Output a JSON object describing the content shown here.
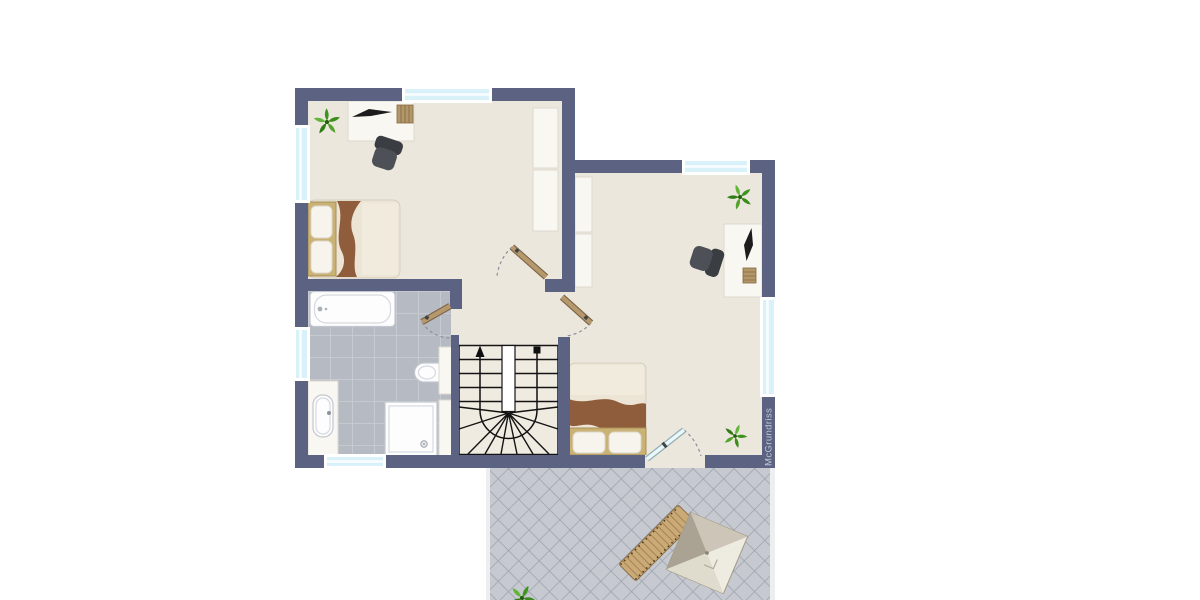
{
  "watermark": "McGrundriss",
  "colors": {
    "wall": "#5b6282",
    "floor": "#ece7dc",
    "stairs": "#f0ebe1",
    "bath-tile": "#b6bac3",
    "bath-grout": "#c9ccd2",
    "terrace-tile": "#c6c9d0",
    "terrace-grout": "#9ba1ab",
    "glass": "#d9f1f8",
    "wood-door": "#b5986e",
    "wood-door-dark": "#7d6644",
    "blanket": "#8f5c3c",
    "bed-frame": "#c9b274",
    "bed-mattress": "#ece4d4",
    "chair-back": "#3a3d41",
    "chair-seat": "#4d5056",
    "furn-white": "#f9f7f2",
    "line": "#141414",
    "watermark": "#c5cad6"
  },
  "floorplan": {
    "type": "upper-floor plan with terrace",
    "rooms": [
      {
        "name": "bedroom-left",
        "furniture": [
          "desk",
          "laptop",
          "desk-chair",
          "wardrobe",
          "single-bed",
          "plant"
        ]
      },
      {
        "name": "bedroom-right",
        "furniture": [
          "desk",
          "laptop",
          "desk-chair",
          "wardrobe",
          "double-bed",
          "plant",
          "plant"
        ]
      },
      {
        "name": "bathroom",
        "furniture": [
          "bathtub",
          "washbasin-counter",
          "toilet",
          "shower",
          "tall-cabinet"
        ]
      },
      {
        "name": "landing",
        "furniture": [
          "winder-staircase"
        ]
      },
      {
        "name": "terrace",
        "furniture": [
          "sun-lounger",
          "parasol",
          "plant"
        ]
      }
    ],
    "doors": [
      "bedroom-left-door",
      "bathroom-door",
      "bedroom-right-door",
      "terrace-glass-door"
    ],
    "windows_count": 6,
    "stairs": {
      "walk_line_start": "square-marker",
      "walk_line_end": "up-arrow"
    }
  }
}
